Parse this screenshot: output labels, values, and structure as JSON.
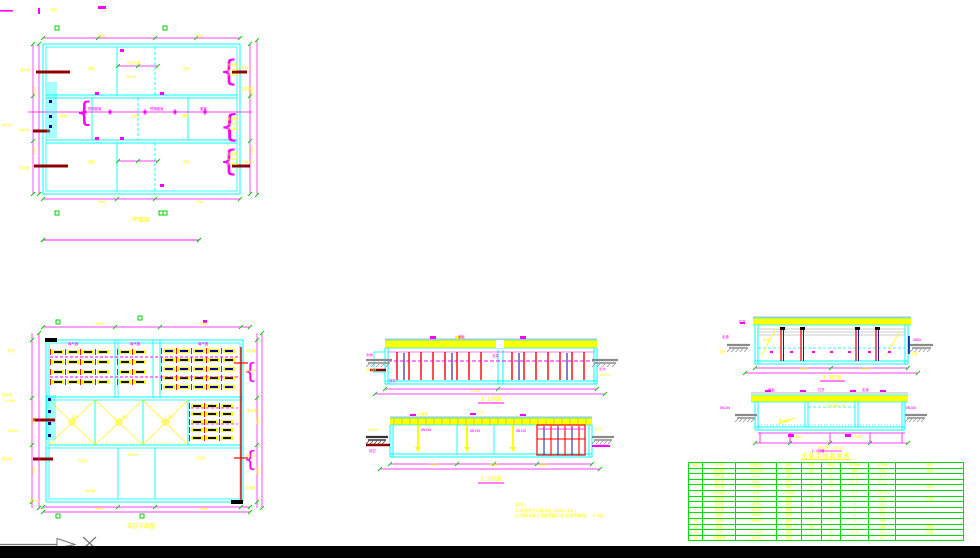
{
  "colors": {
    "wall": "#00ffff",
    "dim": "#ff00ff",
    "label": "#ffff00",
    "tick": "#00d000",
    "table": "#00e000",
    "red": "#ff0000",
    "pipe": "#900000",
    "blue": "#000090",
    "ground": "#8a8a8a",
    "dark": "#333333"
  },
  "views": {
    "plan_top": {
      "title": "平面图",
      "labels": [
        [
          98,
          37,
          "9000",
          "y"
        ],
        [
          196,
          37,
          "9000",
          "y"
        ],
        [
          50,
          11,
          "总图",
          "y"
        ],
        [
          2,
          126,
          "DN300",
          "y"
        ],
        [
          20,
          71,
          "进水管",
          "y"
        ],
        [
          20,
          131,
          "DN200",
          "y"
        ],
        [
          19,
          169,
          "放空管",
          "y"
        ],
        [
          88,
          70,
          "滤池",
          "y"
        ],
        [
          183,
          70,
          "滤池",
          "y"
        ],
        [
          60,
          117,
          "管廊",
          "y"
        ],
        [
          131,
          117,
          "走道",
          "y"
        ],
        [
          182,
          117,
          "管廊",
          "y"
        ],
        [
          88,
          163,
          "滤池",
          "y"
        ],
        [
          183,
          163,
          "滤池",
          "y"
        ],
        [
          127,
          64,
          "反冲洗管",
          "y"
        ],
        [
          126,
          78,
          "DN150",
          "y"
        ],
        [
          88,
          110,
          "预埋套管",
          "m"
        ],
        [
          150,
          110,
          "预埋套管",
          "m"
        ],
        [
          200,
          110,
          "套管",
          "m"
        ],
        [
          227,
          66,
          "出水槽",
          "y"
        ],
        [
          227,
          71,
          "b=300",
          "y"
        ],
        [
          227,
          76,
          "h=400",
          "y"
        ],
        [
          227,
          120,
          "集水槽",
          "y"
        ],
        [
          227,
          125,
          "b=300",
          "y"
        ],
        [
          227,
          130,
          "h=400",
          "y"
        ],
        [
          227,
          155,
          "出水槽",
          "y"
        ],
        [
          227,
          160,
          "b=300",
          "y"
        ],
        [
          227,
          165,
          "h=400",
          "y"
        ],
        [
          240,
          69,
          "DN300",
          "y"
        ],
        [
          241,
          90,
          "溢流管",
          "y"
        ],
        [
          244,
          163,
          "DN300",
          "y"
        ],
        [
          98,
          203,
          "9000",
          "y"
        ],
        [
          196,
          203,
          "9000",
          "y"
        ],
        [
          36,
          95,
          "4500",
          "y",
          3.5,
          -90
        ],
        [
          36,
          155,
          "4500",
          "y",
          3.5,
          -90
        ],
        [
          253,
          95,
          "4500",
          "y",
          3.5,
          -90
        ],
        [
          253,
          155,
          "4500",
          "y",
          3.5,
          -90
        ]
      ]
    },
    "plan_bottom": {
      "title": "底层平面图",
      "labels": [
        [
          95,
          325,
          "9000",
          "y"
        ],
        [
          200,
          325,
          "9000",
          "y"
        ],
        [
          8,
          352,
          "栏杆",
          "y"
        ],
        [
          2,
          396,
          "进水渠",
          "y"
        ],
        [
          5,
          402,
          "b=500",
          "y"
        ],
        [
          8,
          432,
          "DN200",
          "y"
        ],
        [
          2,
          460,
          "放空管",
          "y"
        ],
        [
          30,
          502,
          "DN150",
          "y"
        ],
        [
          68,
          345,
          "曝气器",
          "m"
        ],
        [
          130,
          345,
          "曝气器",
          "m"
        ],
        [
          198,
          345,
          "曝气器",
          "m"
        ],
        [
          72,
          418,
          "泥斗",
          "y"
        ],
        [
          122,
          418,
          "泥斗",
          "y"
        ],
        [
          168,
          418,
          "泥斗",
          "y"
        ],
        [
          78,
          462,
          "沉淀区",
          "y"
        ],
        [
          128,
          456,
          "DN100",
          "y"
        ],
        [
          196,
          459,
          "沉淀区",
          "y"
        ],
        [
          85,
          492,
          "DN150",
          "y"
        ],
        [
          246,
          352,
          "出水堰",
          "y"
        ],
        [
          246,
          372,
          "DN300",
          "y"
        ],
        [
          247,
          412,
          "集水槽",
          "y"
        ],
        [
          246,
          457,
          "DN300",
          "y"
        ],
        [
          245,
          489,
          "出水管",
          "y"
        ],
        [
          95,
          510,
          "9000",
          "y"
        ],
        [
          200,
          510,
          "9000",
          "y"
        ],
        [
          35,
          425,
          "4500",
          "y",
          3.5,
          -90
        ],
        [
          35,
          475,
          "4500",
          "y",
          3.5,
          -90
        ],
        [
          259,
          425,
          "4500",
          "y",
          3.5,
          -90
        ],
        [
          259,
          475,
          "4500",
          "y",
          3.5,
          -90
        ]
      ]
    },
    "section_a": {
      "title": "1-1剖面",
      "labels": [
        [
          366,
          356,
          "水面",
          "m"
        ],
        [
          366,
          371,
          "DN300",
          "y"
        ],
        [
          389,
          382,
          "放空",
          "m"
        ],
        [
          458,
          338,
          "盖板",
          "m"
        ],
        [
          492,
          357,
          "支架",
          "m"
        ],
        [
          599,
          370,
          "出水",
          "m"
        ],
        [
          600,
          376,
          "DN300",
          "y"
        ],
        [
          470,
          392,
          "24000",
          "y"
        ]
      ]
    },
    "section_b": {
      "title": "2-2剖面",
      "labels": [
        [
          418,
          415,
          "走道板",
          "y"
        ],
        [
          477,
          414,
          "栏杆",
          "y"
        ],
        [
          421,
          431,
          "DN150",
          "m"
        ],
        [
          470,
          432,
          "DN150",
          "m"
        ],
        [
          516,
          432,
          "DN150",
          "m"
        ],
        [
          540,
          421,
          "斜管",
          "y"
        ],
        [
          368,
          431,
          "DN300",
          "y"
        ],
        [
          369,
          452,
          "放空",
          "m"
        ],
        [
          595,
          430,
          "出水",
          "y"
        ],
        [
          598,
          447,
          "DN300",
          "m"
        ],
        [
          430,
          466,
          "9000",
          "y"
        ],
        [
          490,
          466,
          "9000",
          "y"
        ],
        [
          540,
          466,
          "6000",
          "y"
        ]
      ]
    },
    "section_c": {
      "title": "3-3剖面",
      "labels": [
        [
          739,
          323,
          "栏杆",
          "m"
        ],
        [
          722,
          338,
          "走道",
          "m"
        ],
        [
          719,
          353,
          "支座",
          "y"
        ],
        [
          911,
          355,
          "支座",
          "y"
        ],
        [
          763,
          341,
          "斜撑",
          "y"
        ],
        [
          913,
          341,
          "DN80",
          "m"
        ],
        [
          800,
          370,
          "6000",
          "y"
        ],
        [
          862,
          370,
          "6000",
          "y"
        ]
      ]
    },
    "section_d": {
      "title": "4-4剖面",
      "sub_label": "泄水坡 i=0.02",
      "labels": [
        [
          768,
          391,
          "盖板",
          "m"
        ],
        [
          818,
          391,
          "栏杆",
          "m"
        ],
        [
          862,
          391,
          "走道",
          "m"
        ],
        [
          779,
          422,
          "集水槽",
          "y"
        ],
        [
          826,
          407,
          "出水槽b=300",
          "y"
        ],
        [
          720,
          409,
          "DN200",
          "m"
        ],
        [
          906,
          409,
          "DN200",
          "m"
        ],
        [
          793,
          438,
          "1500",
          "y"
        ],
        [
          853,
          438,
          "1500",
          "y"
        ]
      ]
    }
  },
  "notes": {
    "heading": "说明:",
    "lines": [
      "1.本图尺寸以毫米计,标高以米计;",
      "2.池体混凝土强度等级C30,抗渗等级S6。 A-A剖"
    ]
  },
  "table": {
    "title": "主要工程数量表",
    "header": [
      "编号",
      "名 称",
      "规格型号",
      "材料",
      "单位",
      "数量",
      "单重kg",
      "总重kg",
      "备注"
    ],
    "rows": [
      [
        "1",
        "进水闸门",
        "500×500",
        "铸铁",
        "台",
        "2",
        "120",
        "240",
        "电动"
      ],
      [
        "2",
        "曝气器",
        "D215",
        "ABS",
        "个",
        "96",
        "0.8",
        "76.8",
        ""
      ],
      [
        "3",
        "穿孔管",
        "DN80",
        "UPVC",
        "m",
        "48",
        "1.2",
        "57.6",
        ""
      ],
      [
        "4",
        "集水槽",
        "b=300",
        "钢砼",
        "m",
        "36",
        "",
        "",
        "现浇"
      ],
      [
        "5",
        "出水堰板",
        "δ=6",
        "不锈钢",
        "m",
        "24",
        "4.7",
        "112.8",
        ""
      ],
      [
        "6",
        "导流板",
        "δ=6",
        "碳钢",
        "块",
        "12",
        "18",
        "216",
        "防腐"
      ],
      [
        "7",
        "排泥管",
        "DN200",
        "铸铁",
        "m",
        "26",
        "52",
        "1352",
        ""
      ],
      [
        "8",
        "放空管",
        "DN150",
        "铸铁",
        "m",
        "8",
        "41",
        "328",
        ""
      ],
      [
        "9",
        "闸阀",
        "DN200",
        "铸铁",
        "个",
        "4",
        "65",
        "260",
        ""
      ],
      [
        "10",
        "止回阀",
        "DN200",
        "铸铁",
        "个",
        "2",
        "70",
        "140",
        ""
      ],
      [
        "11",
        "爬梯",
        "",
        "碳钢",
        "座",
        "4",
        "35",
        "140",
        "防腐"
      ],
      [
        "12",
        "栏杆",
        "H=1100",
        "碳钢",
        "m",
        "86",
        "8.5",
        "731",
        "防腐"
      ],
      [
        "13",
        "预埋套管",
        "DN200",
        "碳钢",
        "个",
        "8",
        "12",
        "96",
        ""
      ]
    ]
  }
}
